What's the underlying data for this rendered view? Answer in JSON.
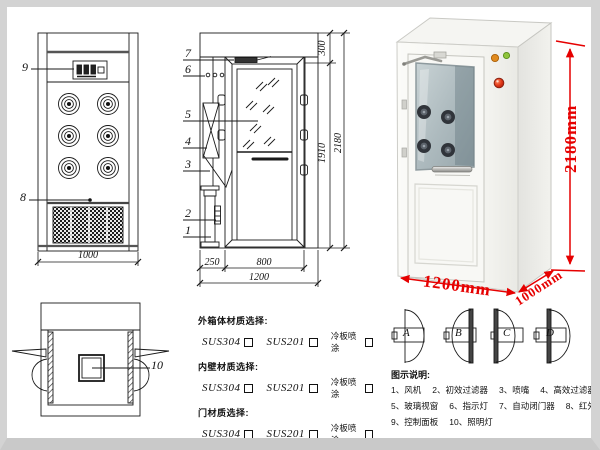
{
  "drawing": {
    "front": {
      "label9": "9",
      "label8": "8",
      "dim_width": "1000"
    },
    "side": {
      "label1": "1",
      "label2": "2",
      "label3": "3",
      "label4": "4",
      "label5": "5",
      "label6": "6",
      "label7": "7",
      "dim_top": "300",
      "dim_door_h": "1910",
      "dim_total_h": "2180",
      "dim_left": "250",
      "dim_door_w": "800",
      "dim_total_w": "1200"
    },
    "top": {
      "label10": "10"
    }
  },
  "photo": {
    "dim_height": "2180mm",
    "dim_width": "1200mm",
    "dim_depth": "1000mm"
  },
  "materials": {
    "groups": [
      {
        "title": "外箱体材质选择:",
        "options": [
          "SUS304",
          "SUS201",
          "冷板喷涂"
        ]
      },
      {
        "title": "内壁材质选择:",
        "options": [
          "SUS304",
          "SUS201",
          "冷板喷涂"
        ]
      },
      {
        "title": "门材质选择:",
        "options": [
          "SUS304",
          "SUS201",
          "冷板喷涂"
        ]
      }
    ]
  },
  "door_options": {
    "a": "A",
    "b": "B",
    "c": "C",
    "d": "D"
  },
  "legend": {
    "title": "图示说明:",
    "rows": [
      [
        "1、风机",
        "2、初效过滤器",
        "3、喷嘴",
        "4、高效过滤器"
      ],
      [
        "5、玻璃视窗",
        "6、指示灯",
        "7、自动闭门器",
        "8、红外线感应器"
      ],
      [
        "9、控制面板",
        "10、照明灯"
      ]
    ]
  },
  "colors": {
    "dimension_red": "#e60000",
    "line_black": "#1a1a1a"
  }
}
